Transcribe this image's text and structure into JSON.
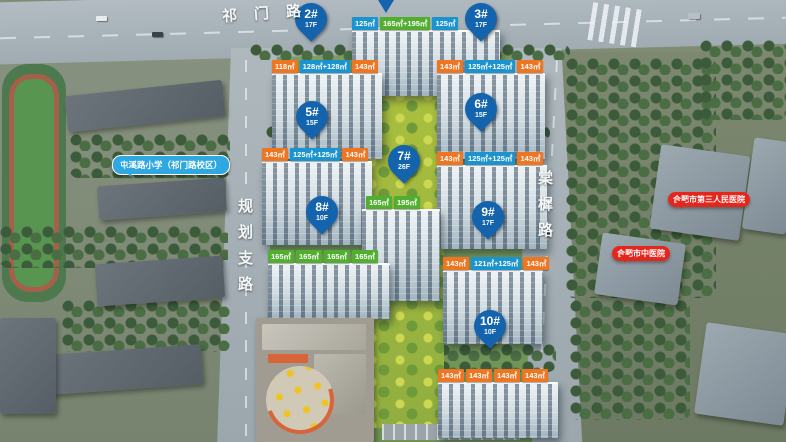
{
  "colors": {
    "chip_blue": "#1b93cf",
    "chip_orange": "#ee7623",
    "chip_green": "#52ae30",
    "pin_blue": "#1464ad",
    "bubble_red": "#e5261c",
    "bubble_blue": "#2fa7e0"
  },
  "roads": {
    "top": {
      "name": "祁门路"
    },
    "left": {
      "name": "规划支路"
    },
    "right": {
      "name": "棠樨路"
    }
  },
  "landmarks": {
    "school": {
      "label": "屯溪路小学（祁门路校区）"
    },
    "hospital_1": {
      "label": "合肥市第三人民医院"
    },
    "hospital_2": {
      "label": "合肥市中医院"
    }
  },
  "buildings": {
    "b1": {
      "units": [
        {
          "text": "125㎡"
        },
        {
          "text": "165㎡+195㎡"
        },
        {
          "text": "125㎡"
        }
      ]
    },
    "b2": {
      "id": "2#",
      "floors": "17F",
      "units": [
        {
          "text": "118㎡"
        },
        {
          "text": "128㎡+128㎡"
        },
        {
          "text": "143㎡"
        }
      ]
    },
    "b3": {
      "id": "3#",
      "floors": "17F",
      "units": [
        {
          "text": "143㎡"
        },
        {
          "text": "125㎡+125㎡"
        },
        {
          "text": "143㎡"
        }
      ]
    },
    "b5": {
      "id": "5#",
      "floors": "15F",
      "units": [
        {
          "text": "143㎡"
        },
        {
          "text": "125㎡+125㎡"
        },
        {
          "text": "143㎡"
        }
      ]
    },
    "b6": {
      "id": "6#",
      "floors": "15F",
      "units": [
        {
          "text": "143㎡"
        },
        {
          "text": "125㎡+125㎡"
        },
        {
          "text": "143㎡"
        }
      ]
    },
    "b7": {
      "id": "7#",
      "floors": "26F",
      "units": [
        {
          "text": "165㎡"
        },
        {
          "text": "195㎡"
        }
      ]
    },
    "b8": {
      "id": "8#",
      "floors": "10F",
      "units": [
        {
          "text": "165㎡"
        },
        {
          "text": "165㎡"
        },
        {
          "text": "165㎡"
        },
        {
          "text": "165㎡"
        }
      ]
    },
    "b9": {
      "id": "9#",
      "floors": "17F",
      "units": [
        {
          "text": "143㎡"
        },
        {
          "text": "121㎡+125㎡"
        },
        {
          "text": "143㎡"
        }
      ]
    },
    "b10": {
      "id": "10#",
      "floors": "10F",
      "units": [
        {
          "text": "143㎡"
        },
        {
          "text": "143㎡"
        },
        {
          "text": "143㎡"
        },
        {
          "text": "143㎡"
        }
      ]
    }
  }
}
